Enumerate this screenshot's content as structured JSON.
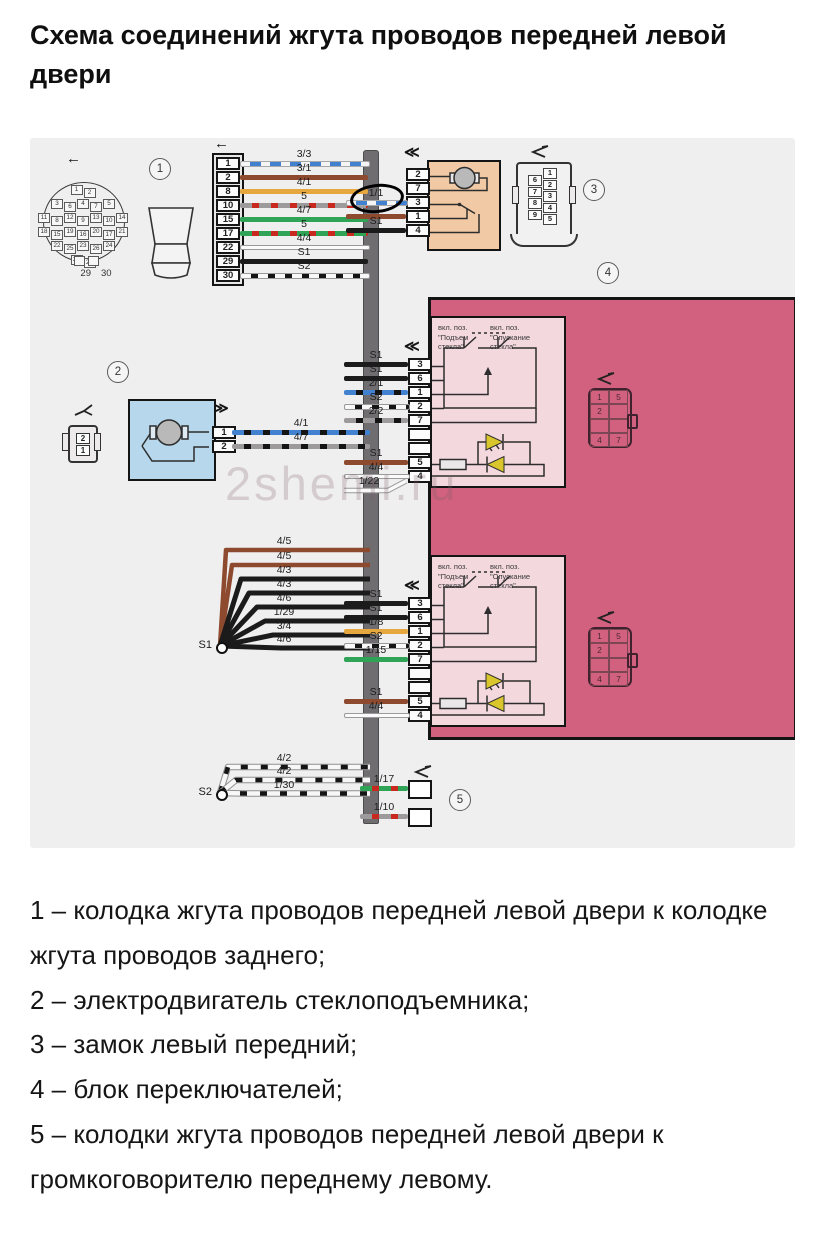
{
  "title": "Схема соединений жгута проводов передней левой двери",
  "watermark": "2shemi.ru",
  "icons": {
    "left_arrow": "←",
    "double_left": "≪",
    "double_right": "≫"
  },
  "callouts": {
    "c1": "1",
    "c2": "2",
    "c3": "3",
    "c4": "4",
    "c5": "5"
  },
  "splices": {
    "s1": "S1",
    "s2": "S2"
  },
  "connector1": {
    "pins": [
      "1",
      "2",
      "8",
      "10",
      "15",
      "17",
      "22",
      "29",
      "30"
    ],
    "wires": [
      {
        "label": "3/3",
        "style": "blue-dash"
      },
      {
        "label": "3/1",
        "style": "brown"
      },
      {
        "label": "4/1",
        "style": "orange"
      },
      {
        "label": "5",
        "style": "gray-red"
      },
      {
        "label": "4/7",
        "style": "green"
      },
      {
        "label": "5",
        "style": "green-red"
      },
      {
        "label": "4/4",
        "style": "white"
      },
      {
        "label": "S1",
        "style": "black"
      },
      {
        "label": "S2",
        "style": "white-black"
      }
    ],
    "round_face_rows": [
      [
        "1",
        "2"
      ],
      [
        "3",
        "6",
        "4",
        "7",
        "5"
      ],
      [
        "11",
        "8",
        "12",
        "9",
        "13",
        "10",
        "14"
      ],
      [
        "18",
        "15",
        "19",
        "16",
        "20",
        "17",
        "21"
      ],
      [
        "22",
        "25",
        "23",
        "26",
        "24"
      ],
      [
        "27",
        "28"
      ]
    ],
    "round_face_tabs": [
      "29",
      "30"
    ]
  },
  "lock": {
    "pins": [
      "2",
      "7",
      "3",
      "1",
      "4"
    ],
    "wires": [
      {
        "label": "1/1",
        "style": "blue-dash",
        "pin": 2,
        "circled": true
      },
      {
        "label": "",
        "style": "brown",
        "pin": 3
      },
      {
        "label": "S1",
        "style": "black",
        "pin": 4
      }
    ],
    "face_left": [
      "6",
      "7",
      "8",
      "9"
    ],
    "face_right": [
      "1",
      "2",
      "3",
      "4",
      "5"
    ]
  },
  "motor": {
    "pins": [
      "1",
      "2"
    ],
    "wires": [
      {
        "label": "4/1",
        "style": "blue-black",
        "pin": 0
      },
      {
        "label": "4/7",
        "style": "gray-black",
        "pin": 1
      }
    ],
    "face": [
      "2",
      "1"
    ]
  },
  "switches": {
    "captions_left": [
      "вкл. поз.",
      "\"Подъем",
      "стекла\""
    ],
    "captions_right": [
      "вкл. поз.",
      "\"Опускание",
      "стекла\""
    ],
    "face_cells": [
      [
        "1",
        "5"
      ],
      [
        "2",
        ""
      ],
      [
        "",
        ""
      ],
      [
        "4",
        "7"
      ]
    ],
    "upper": {
      "pins": [
        "3",
        "6",
        "1",
        "2",
        "7",
        "",
        "",
        "5",
        "4"
      ],
      "wires": [
        {
          "label": "S1",
          "style": "black",
          "pin": 0
        },
        {
          "label": "S1",
          "style": "black",
          "pin": 1
        },
        {
          "label": "2/1",
          "style": "blue-black",
          "pin": 2
        },
        {
          "label": "S2",
          "style": "white-black",
          "pin": 3
        },
        {
          "label": "2/2",
          "style": "gray-black",
          "pin": 4
        },
        {
          "label": "S1",
          "style": "brown",
          "pin": 7
        },
        {
          "label": "4/4",
          "style": "white",
          "pin": 8
        }
      ],
      "extra_wire": {
        "label": "1/22",
        "style": "white"
      }
    },
    "lower": {
      "pins": [
        "3",
        "6",
        "1",
        "2",
        "7",
        "",
        "",
        "5",
        "4"
      ],
      "wires": [
        {
          "label": "S1",
          "style": "black",
          "pin": 0
        },
        {
          "label": "S1",
          "style": "black",
          "pin": 1
        },
        {
          "label": "1/8",
          "style": "orange",
          "pin": 2
        },
        {
          "label": "S2",
          "style": "white-black",
          "pin": 3
        },
        {
          "label": "1/15",
          "style": "green",
          "pin": 4
        },
        {
          "label": "S1",
          "style": "brown",
          "pin": 7
        },
        {
          "label": "4/4",
          "style": "white",
          "pin": 8
        }
      ]
    }
  },
  "s1_bundle": [
    {
      "label": "4/5",
      "style": "brown"
    },
    {
      "label": "4/5",
      "style": "brown"
    },
    {
      "label": "4/3",
      "style": "black"
    },
    {
      "label": "4/3",
      "style": "black"
    },
    {
      "label": "4/6",
      "style": "black"
    },
    {
      "label": "1/29",
      "style": "black"
    },
    {
      "label": "3/4",
      "style": "black"
    },
    {
      "label": "4/6",
      "style": "black"
    }
  ],
  "s2_bundle": [
    {
      "label": "4/2",
      "style": "white-black"
    },
    {
      "label": "4/2",
      "style": "white-black"
    },
    {
      "label": "1/30",
      "style": "white-black"
    }
  ],
  "speaker_wires": [
    {
      "label": "1/17",
      "style": "green-red"
    },
    {
      "label": "1/10",
      "style": "gray-red"
    }
  ],
  "legend": [
    "1 – колодка жгута проводов передней левой двери к колодке жгута проводов заднего;",
    "2 – электродвигатель стеклоподъемника;",
    "3 – замок левый передний;",
    "4 – блок переключателей;",
    "5 – колодки жгута проводов передней левой двери к громкоговорителю переднему левому."
  ]
}
